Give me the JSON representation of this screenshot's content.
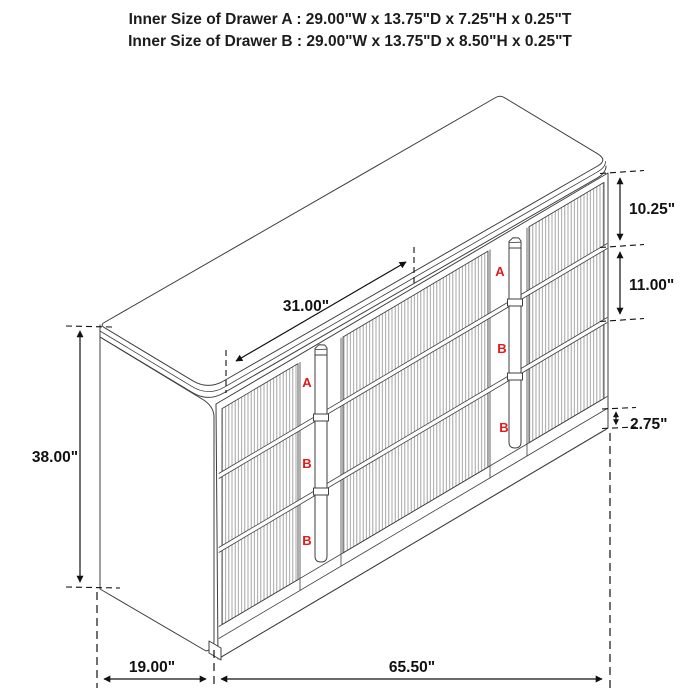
{
  "title": {
    "line1": "Inner Size of Drawer A : 29.00\"W x 13.75\"D x 7.25\"H x 0.25\"T",
    "line2": "Inner Size of Drawer B : 29.00\"W x 13.75\"D x 8.50\"H x 0.25\"T"
  },
  "dimensions": {
    "drawer_row_width": "31.00\"",
    "overall_height": "38.00\"",
    "top_drawer_height": "10.25\"",
    "middle_drawer_height": "11.00\"",
    "base_height": "2.75\"",
    "overall_depth": "19.00\"",
    "overall_width": "65.50\""
  },
  "drawers": {
    "middle_column": [
      "A",
      "B",
      "B"
    ],
    "right_column": [
      "A",
      "B",
      "B"
    ]
  },
  "colors": {
    "outline": "#3f3f3f",
    "flute": "#9a9a9a",
    "dimension": "#111111",
    "drawer_label": "#e01b1b",
    "background": "#ffffff"
  }
}
